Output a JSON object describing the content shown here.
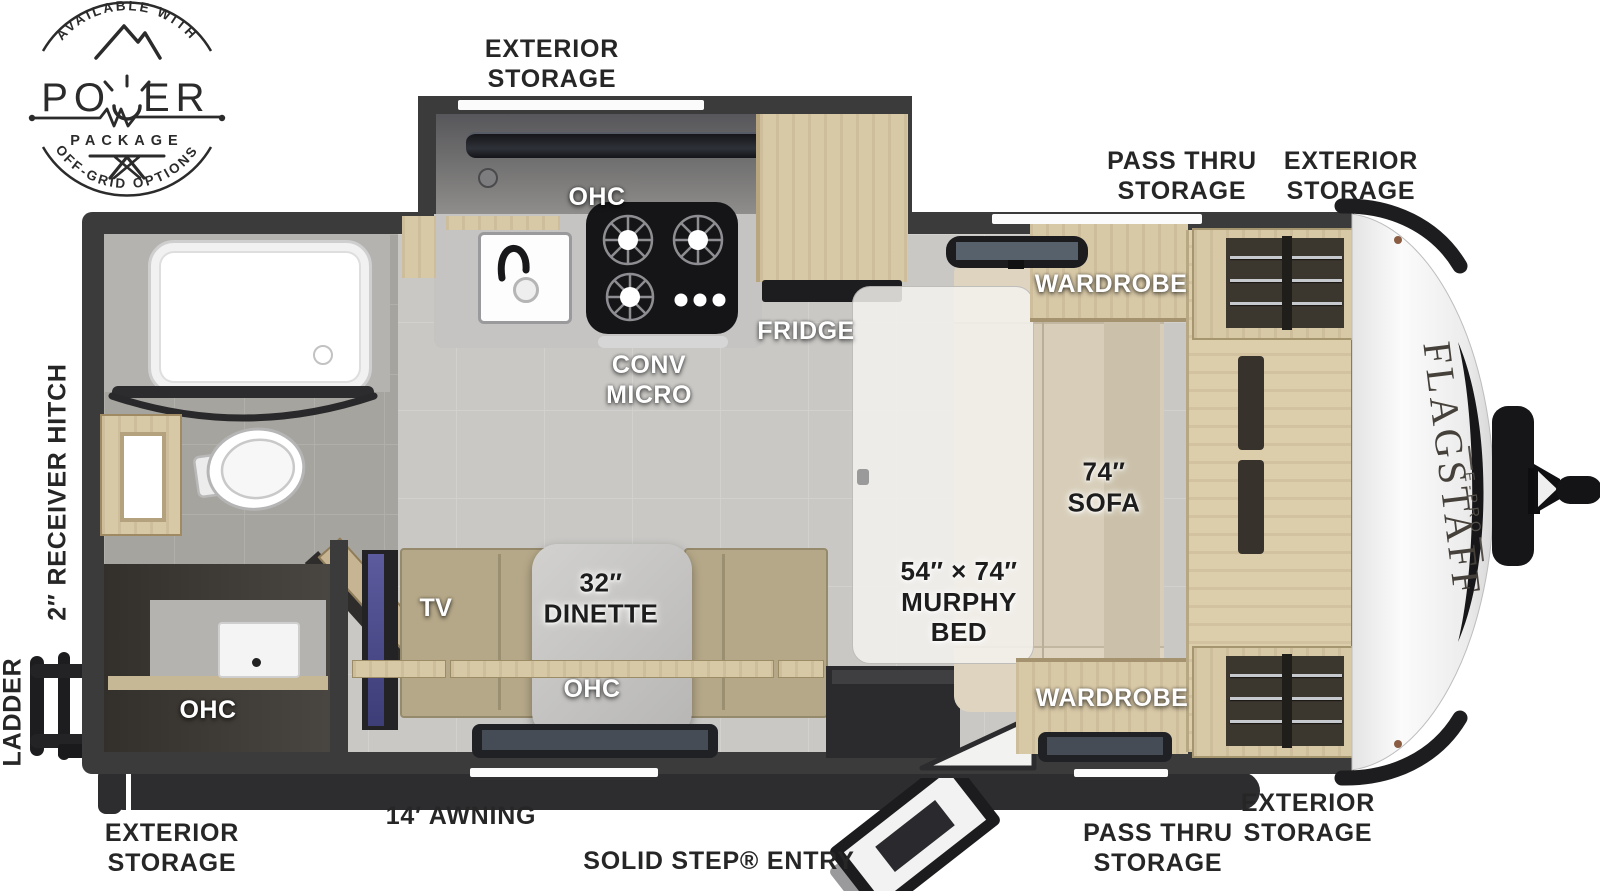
{
  "badge": {
    "arc_top": "AVAILABLE WITH",
    "power_left": "PO",
    "power_right": "ER",
    "package": "PACKAGE",
    "arc_bottom": "OFF-GRID OPTIONS"
  },
  "exterior_labels": {
    "kitchen_storage_top": "EXTERIOR\nSTORAGE",
    "pass_thru_top": "PASS THRU\nSTORAGE",
    "exterior_front_top": "EXTERIOR\nSTORAGE",
    "receiver_hitch": "2″ RECEIVER HITCH",
    "ladder": "LADDER",
    "rear_storage_bottom": "EXTERIOR\nSTORAGE",
    "awning": "14′ AWNING",
    "entry": "SOLID STEP® ENTRY",
    "pass_thru_bottom": "PASS THRU\nSTORAGE",
    "exterior_front_bottom": "EXTERIOR\nSTORAGE"
  },
  "room_labels": {
    "kitchen_ohc": "OHC",
    "conv_micro": "CONV\nMICRO",
    "fridge": "FRIDGE",
    "wardrobe_top": "WARDROBE",
    "wardrobe_bottom": "WARDROBE",
    "sofa": "74″\nSOFA",
    "murphy_bed": "54″ × 74″\nMURPHY\nBED",
    "dinette": "32″\nDINETTE",
    "dinette_ohc": "OHC",
    "tv": "TV",
    "rear_ohc": "OHC"
  },
  "brand": {
    "model": "FLAGSTAFF",
    "series": "E-PRO"
  }
}
